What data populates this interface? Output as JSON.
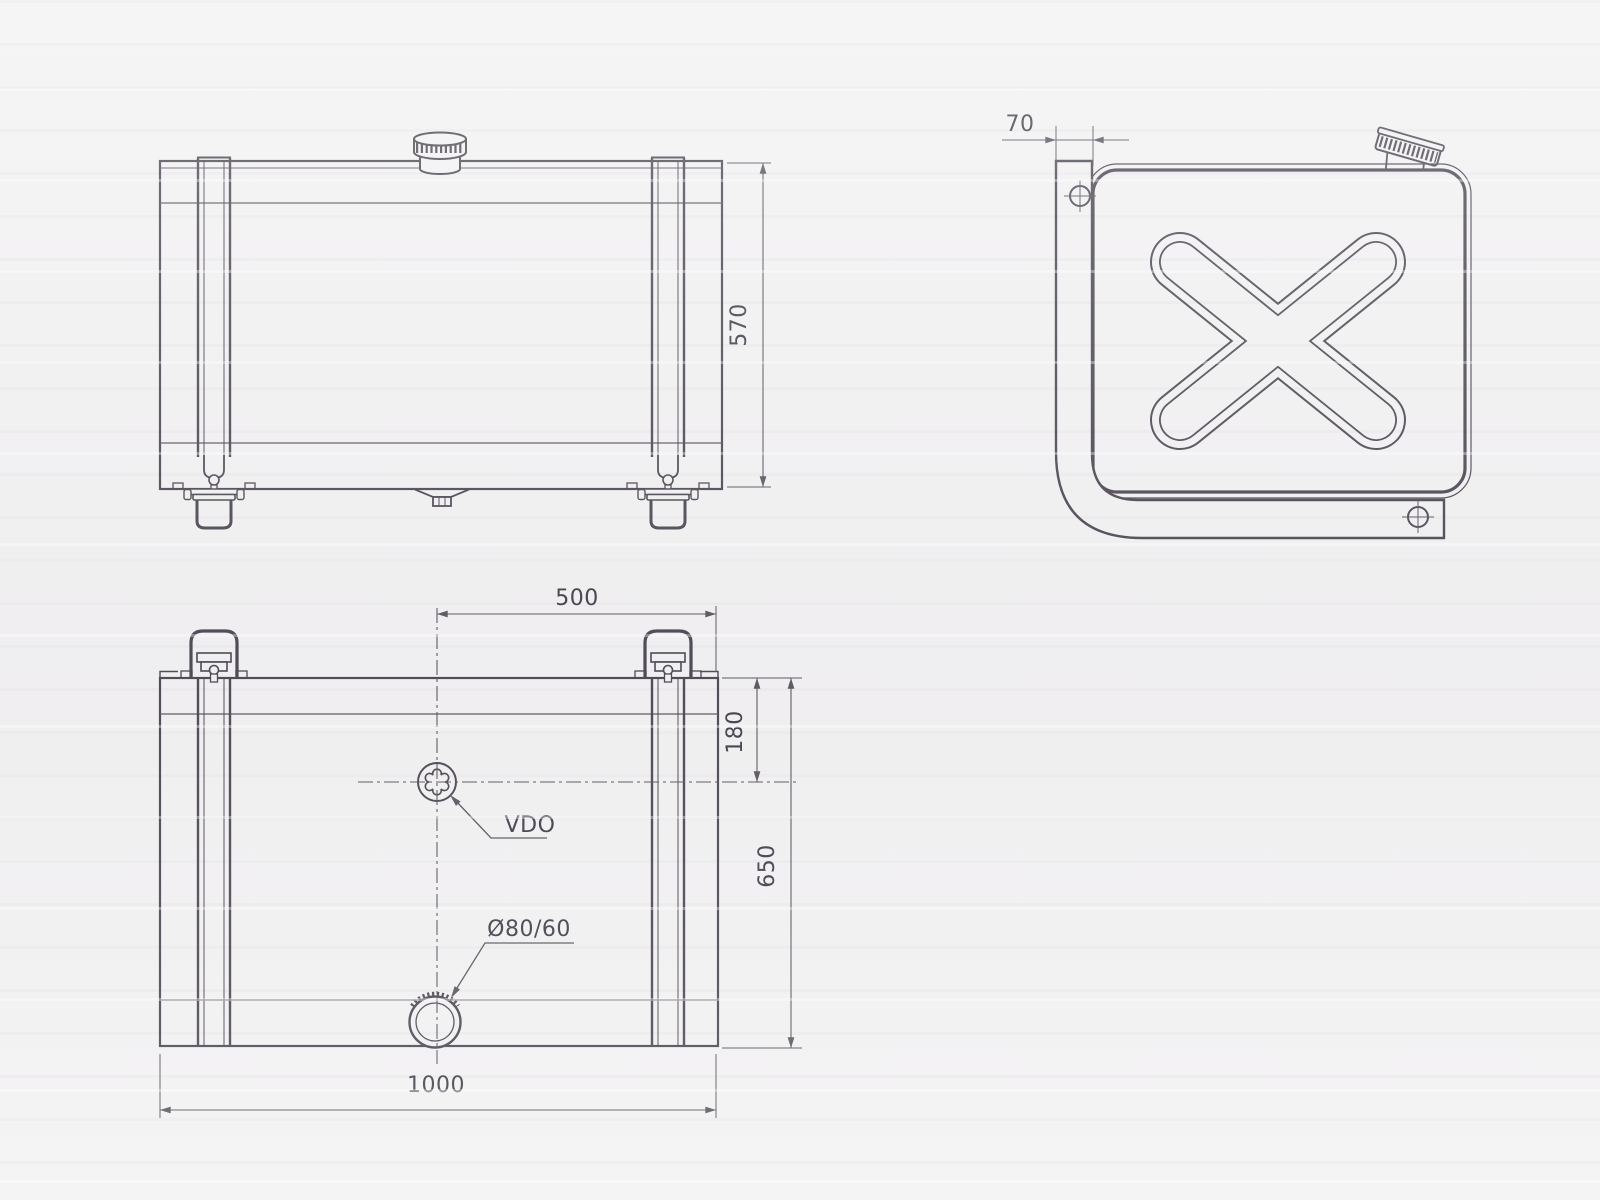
{
  "drawing": {
    "dimensions": {
      "tank_height": "570",
      "bracket_width": "70",
      "filler_to_edge": "500",
      "sender_to_edge": "180",
      "tank_depth": "650",
      "tank_length": "1000"
    },
    "labels": {
      "sender_unit": "VDO",
      "filler_neck": "Ø80/60"
    },
    "colors": {
      "paper": "#f3f2f3",
      "line": "#4f4a55",
      "dim": "#5d5862",
      "text": "#45414c"
    }
  }
}
